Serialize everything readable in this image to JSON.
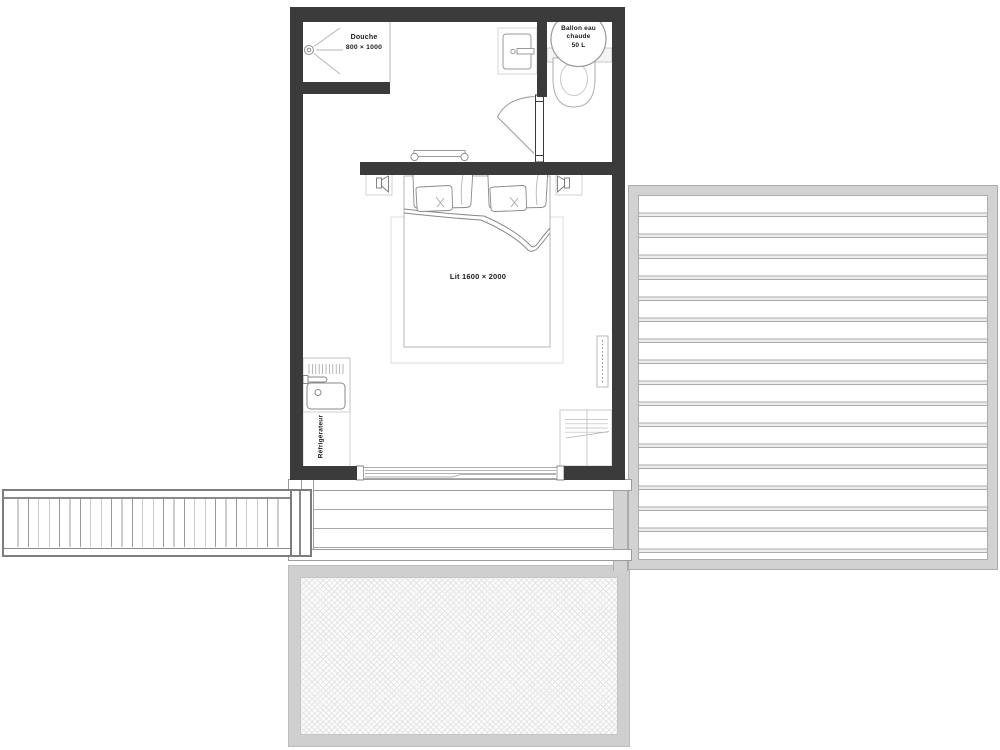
{
  "plan": {
    "labels": {
      "shower_name": "Douche",
      "shower_dimensions": "800 × 1000",
      "water_heater_1": "Ballon eau",
      "water_heater_2": "chaude",
      "water_heater_3": "50 L",
      "bed": "Lit 1600 × 2000",
      "refrigerator": "Réfrigérateur"
    },
    "colors": {
      "wall": "#3b3b3b",
      "deck_frame": "#d2d2d2",
      "plank_line": "#ababab",
      "fixture_line": "#9a9a9a",
      "label_text": "#1c1c1c",
      "background": "#ffffff"
    }
  }
}
